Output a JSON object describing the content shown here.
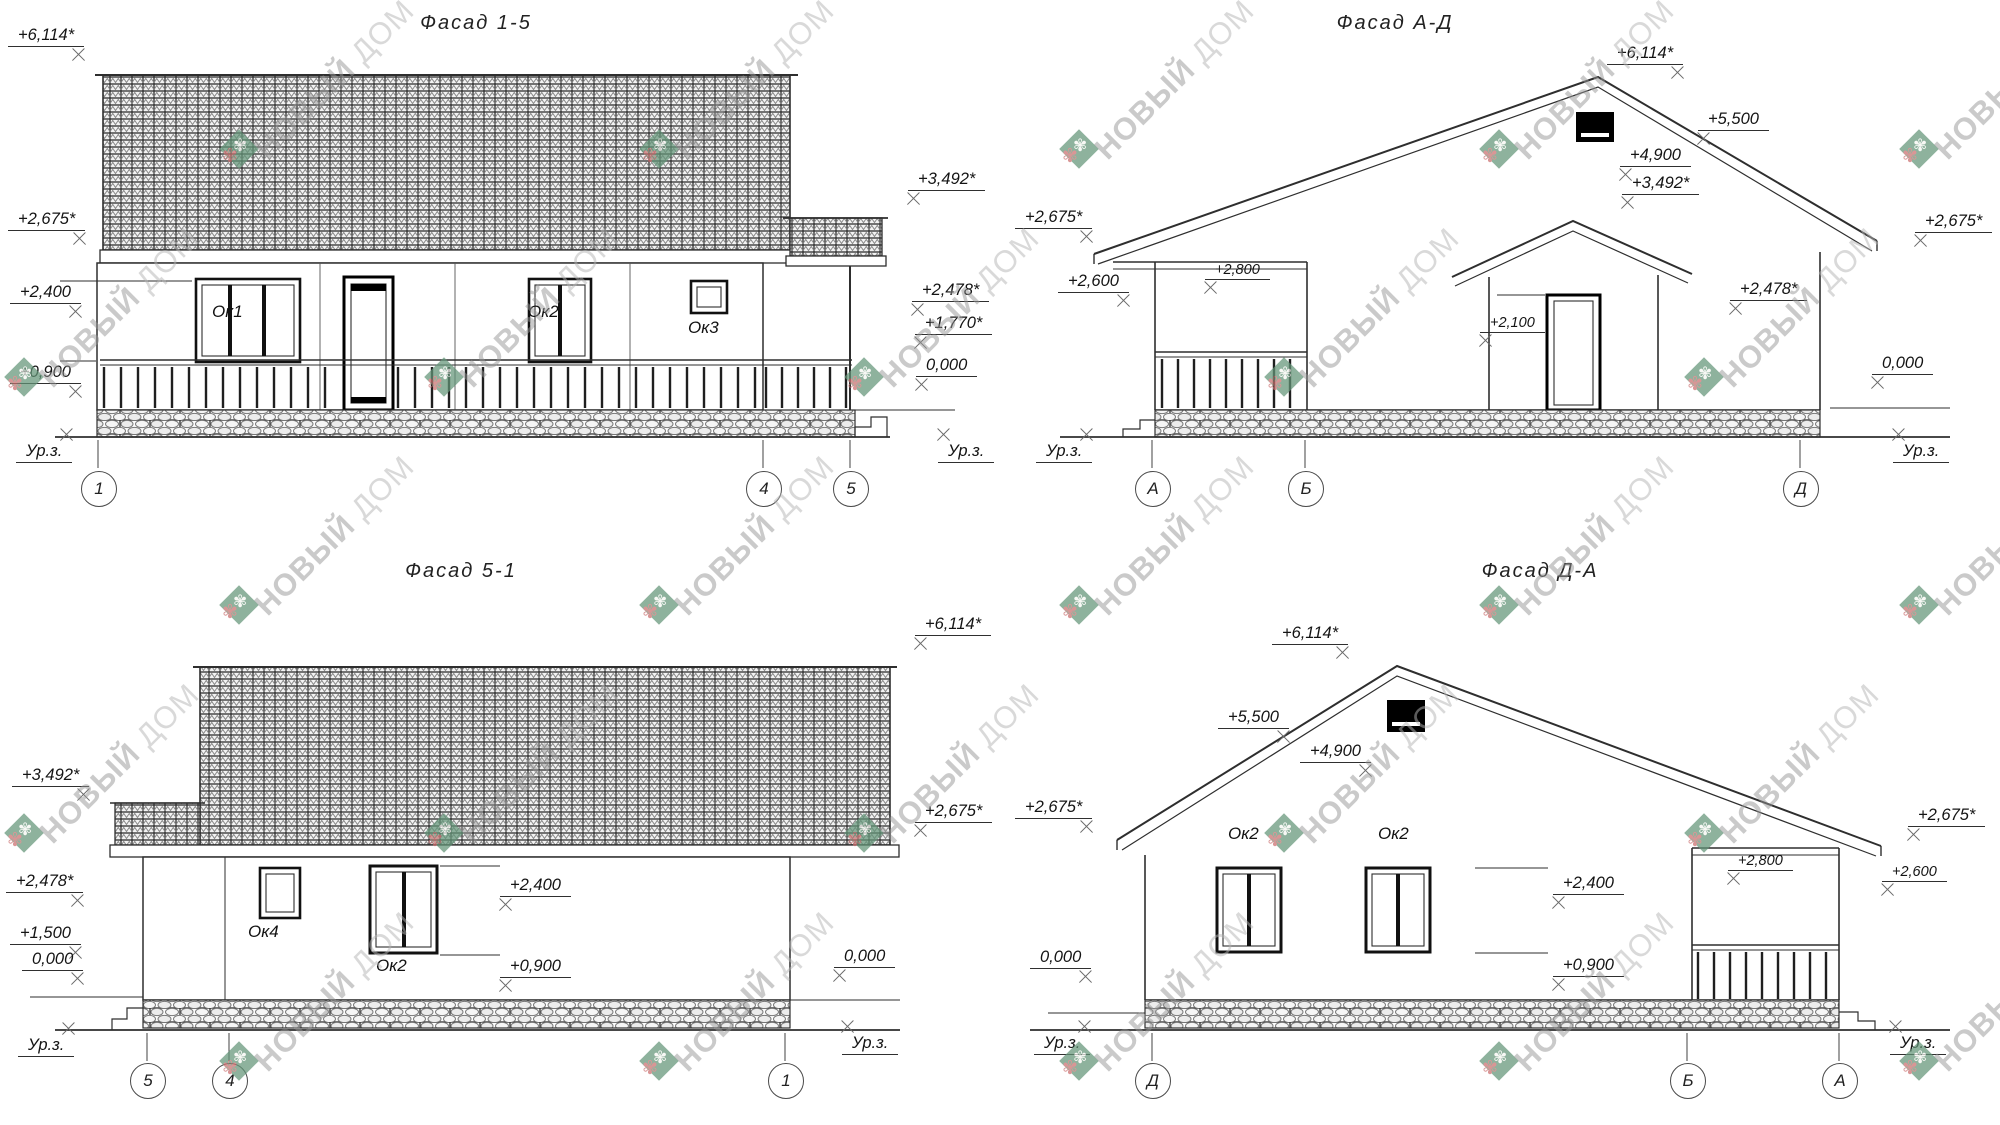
{
  "labels": {
    "ground": "Ур.з."
  },
  "watermark": {
    "brand_primary": "НОВЫЙ",
    "brand_secondary": "ДОМ",
    "logo_green": "#639578",
    "logo_red": "#cb6f6f",
    "text_color": "#979797",
    "positions": [
      [
        240,
        150
      ],
      [
        660,
        150
      ],
      [
        1080,
        150
      ],
      [
        1500,
        150
      ],
      [
        1920,
        150
      ],
      [
        25,
        378
      ],
      [
        445,
        378
      ],
      [
        865,
        378
      ],
      [
        1285,
        378
      ],
      [
        1705,
        378
      ],
      [
        240,
        606
      ],
      [
        660,
        606
      ],
      [
        1080,
        606
      ],
      [
        1500,
        606
      ],
      [
        1920,
        606
      ],
      [
        25,
        834
      ],
      [
        445,
        834
      ],
      [
        865,
        834
      ],
      [
        1285,
        834
      ],
      [
        1705,
        834
      ],
      [
        240,
        1062
      ],
      [
        660,
        1062
      ],
      [
        1080,
        1062
      ],
      [
        1500,
        1062
      ],
      [
        1920,
        1062
      ]
    ]
  },
  "f15": {
    "title": "Фасад 1-5",
    "windows": {
      "w1": "Ок1",
      "w2": "Ок2",
      "w3": "Ок3"
    },
    "axes": [
      "1",
      "4",
      "5"
    ],
    "marks": {
      "m6114": "+6,114*",
      "m2675": "+2,675*",
      "m2400": "+2,400",
      "m0900": "+0,900",
      "m3492": "+3,492*",
      "m2478": "+2,478*",
      "m1770": "+1,770*",
      "m0000": "0,000"
    }
  },
  "fad": {
    "title": "Фасад А-Д",
    "axes": [
      "А",
      "Б",
      "Д"
    ],
    "marks": {
      "m6114": "+6,114*",
      "m5500": "+5,500",
      "m4900": "+4,900",
      "m3492": "+3,492*",
      "m2675l": "+2,675*",
      "m2600": "+2,600",
      "m2800": "+2,800",
      "m2100": "+2,100",
      "m2478": "+2,478*",
      "m2675r": "+2,675*",
      "m0000": "0,000"
    }
  },
  "f51": {
    "title": "Фасад 5-1",
    "windows": {
      "w4": "Ок4",
      "w2": "Ок2"
    },
    "axes": [
      "5",
      "4",
      "1"
    ],
    "marks": {
      "m3492": "+3,492*",
      "m2478": "+2,478*",
      "m1500": "+1,500",
      "m0000l": "0,000",
      "m6114": "+6,114*",
      "m2675": "+2,675*",
      "m2400": "+2,400",
      "m0900": "+0,900",
      "m0000r": "0,000"
    }
  },
  "fda": {
    "title": "Фасад Д-А",
    "windows": {
      "w2a": "Ок2",
      "w2b": "Ок2"
    },
    "axes": [
      "Д",
      "Б",
      "А"
    ],
    "marks": {
      "m6114": "+6,114*",
      "m5500": "+5,500",
      "m4900": "+4,900",
      "m2675l": "+2,675*",
      "m0000l": "0,000",
      "m2675r": "+2,675*",
      "m2800": "+2,800",
      "m2600": "+2,600",
      "m2400": "+2,400",
      "m0900": "+0,900"
    }
  }
}
